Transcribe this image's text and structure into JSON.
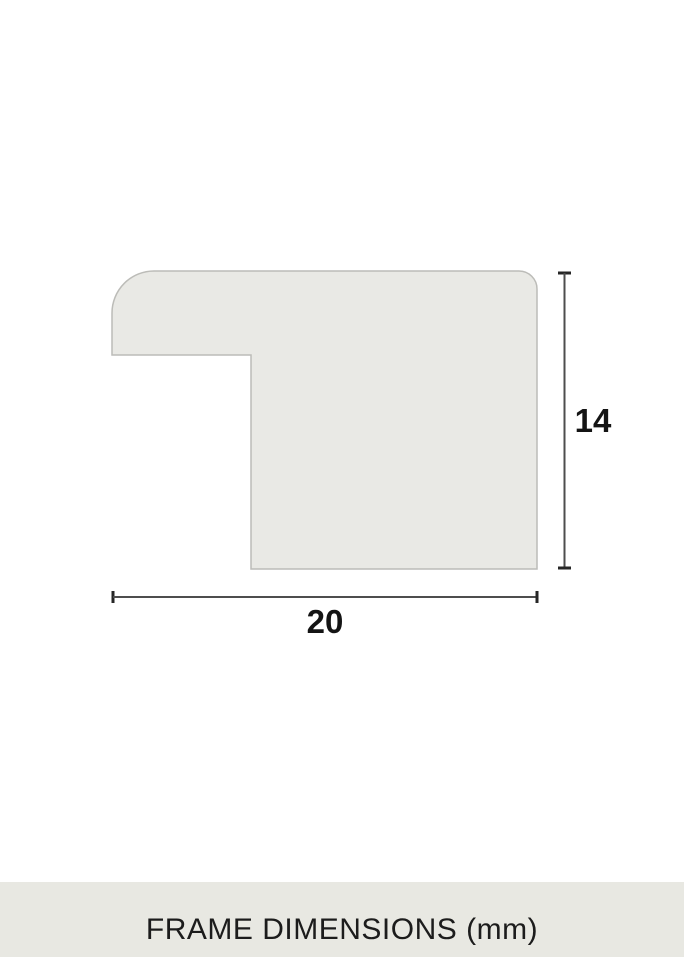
{
  "theme": {
    "page-bg": "#ffffff",
    "profile-fill": "#e9e9e5",
    "profile-stroke": "#bcbcb8",
    "dim-line": "#4d4d4d",
    "dim-tick": "#262626",
    "dim-label": "#141414",
    "footer-bg": "#e8e8e2",
    "footer-text": "#1c1c1c"
  },
  "diagram": {
    "description": "frame-moulding-profile-cross-section",
    "height_label": "14",
    "width_label": "20"
  },
  "footer": {
    "caption": "FRAME DIMENSIONS (mm)"
  }
}
